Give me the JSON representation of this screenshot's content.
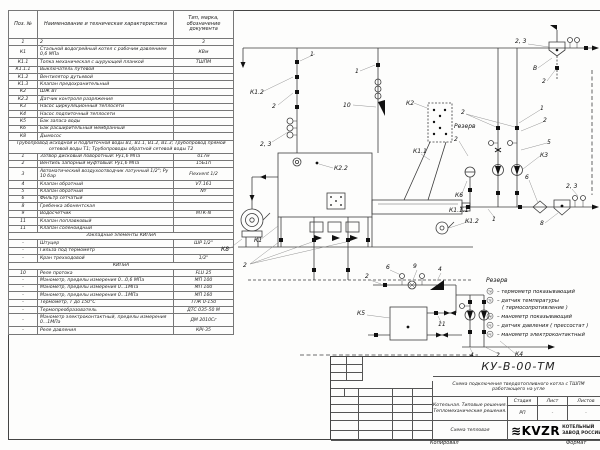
{
  "parts_table": {
    "headers": [
      "Поз. №",
      "Наименование и техническая характеристика",
      "Тип, марка, обозначение документа"
    ],
    "rows": [
      {
        "p": "1",
        "n": "2",
        "t": "3"
      },
      {
        "p": "К1",
        "n": "Стальной водогрейный котел с рабочим давлением 0,6 МПа",
        "t": "КВм"
      },
      {
        "p": "К1.1",
        "n": "Топка механическая с шурующей планкой",
        "t": "ТШПМ"
      },
      {
        "p": "К1.1.1",
        "n": "Выключатель путевой",
        "t": ""
      },
      {
        "p": "К1.2",
        "n": "Вентилятор дутьевой",
        "t": ""
      },
      {
        "p": "К1.3",
        "n": "Клапан предохранительный",
        "t": ""
      },
      {
        "p": "К2",
        "n": "ШЖ ВТ",
        "t": ""
      },
      {
        "p": "К2.2",
        "n": "Датчик контроля разряжения",
        "t": ""
      },
      {
        "p": "К3",
        "n": "Насос циркуляционный теплосети",
        "t": ""
      },
      {
        "p": "К4",
        "n": "Насос подпиточный теплосети",
        "t": ""
      },
      {
        "p": "К5",
        "n": "Бак запаса воды",
        "t": ""
      },
      {
        "p": "К6",
        "n": "Бак расширительный мембранный",
        "t": ""
      },
      {
        "p": "К8",
        "n": "Дымосос",
        "t": ""
      },
      {
        "s": "Трубопровод исходной и подпиточной воды В1, В1.1, В1.2, В1.3; Трубопровод прямой сетевой воды Т1; Трубопроводы обратной сетевой воды Т2"
      },
      {
        "p": "1",
        "n": "Затвор дисковый поворотный: Ру1,6 МПа",
        "t": "017м"
      },
      {
        "p": "2",
        "n": "Вентиль запорный муфтовый: Ру1,6 МПа",
        "t": "15Б1п"
      },
      {
        "p": "3",
        "n": "Автоматический воздухоотводчик латунный 1/2\"; Ру 10 бар",
        "t": "Flexvent 1/2"
      },
      {
        "p": "4",
        "n": "Клапан обратный",
        "t": "V7.161"
      },
      {
        "p": "5",
        "n": "Клапан обратный",
        "t": "NY"
      },
      {
        "p": "6",
        "n": "Фильтр сетчатый",
        "t": ""
      },
      {
        "p": "8",
        "n": "Гребенка абонентская",
        "t": ""
      },
      {
        "p": "9",
        "n": "Водосчетчик",
        "t": "МТК-N"
      },
      {
        "p": "11",
        "n": "Клапан поплавковый",
        "t": ""
      },
      {
        "p": "11",
        "n": "Клапан соленоидный",
        "t": ""
      },
      {
        "s": "Закладные элементы КИПиА"
      },
      {
        "p": "–",
        "n": "Штуцер",
        "t": "ШР 1/2\""
      },
      {
        "p": "–",
        "n": "Гильза под термометр",
        "t": ""
      },
      {
        "p": "–",
        "n": "Кран трехходовой",
        "t": "1/2\""
      },
      {
        "s": "КИПиА"
      },
      {
        "p": "10",
        "n": "Реле протока",
        "t": "FLU 25"
      },
      {
        "p": "–",
        "n": "Манометр, пределы измерения 0...0,6 МПа",
        "t": "МП 100"
      },
      {
        "p": "–",
        "n": "Манометр, пределы измерения 0...1МПа",
        "t": "МП 100"
      },
      {
        "p": "–",
        "n": "Манометр, пределы измерения 0...1МПа",
        "t": "МП 160"
      },
      {
        "p": "–",
        "n": "Термометр, Т до 150°С",
        "t": "ТТЖ 0-150"
      },
      {
        "p": "–",
        "n": "Термопреобразователь",
        "t": "ДТС 035-50 М"
      },
      {
        "p": "–",
        "n": "Манометр электроконтактный, пределы измерения 0...1МПа",
        "t": "ДМ 2010Сг"
      },
      {
        "p": "–",
        "n": "Реле давления",
        "t": "КРI-35"
      }
    ]
  },
  "schematic": {
    "labels": [
      {
        "t": "1",
        "x": 92,
        "y": 46
      },
      {
        "t": "К1.2",
        "x": 32,
        "y": 84
      },
      {
        "t": "2",
        "x": 54,
        "y": 98
      },
      {
        "t": "2, 3",
        "x": 42,
        "y": 136
      },
      {
        "t": "1",
        "x": 137,
        "y": 63
      },
      {
        "t": "10",
        "x": 125,
        "y": 97
      },
      {
        "t": "2, 3",
        "x": 297,
        "y": 33
      },
      {
        "t": "В",
        "x": 315,
        "y": 60
      },
      {
        "t": "2",
        "x": 324,
        "y": 73
      },
      {
        "t": "К2.2",
        "x": 116,
        "y": 160
      },
      {
        "t": "К1",
        "x": 36,
        "y": 232
      },
      {
        "t": "К8",
        "x": 3,
        "y": 241
      },
      {
        "t": "2",
        "x": 25,
        "y": 257
      },
      {
        "t": "К2",
        "x": 188,
        "y": 95
      },
      {
        "t": "Резерв",
        "x": 236,
        "y": 118
      },
      {
        "t": "К1.1",
        "x": 195,
        "y": 143
      },
      {
        "t": "К1.1.1",
        "x": 231,
        "y": 202
      },
      {
        "t": "К1.2",
        "x": 247,
        "y": 213
      },
      {
        "t": "1",
        "x": 274,
        "y": 211
      },
      {
        "t": "2",
        "x": 243,
        "y": 104
      },
      {
        "t": "1",
        "x": 322,
        "y": 100
      },
      {
        "t": "2",
        "x": 325,
        "y": 112
      },
      {
        "t": "5",
        "x": 329,
        "y": 134
      },
      {
        "t": "К3",
        "x": 322,
        "y": 147
      },
      {
        "t": "2",
        "x": 236,
        "y": 131
      },
      {
        "t": "К6",
        "x": 237,
        "y": 187
      },
      {
        "t": "6",
        "x": 307,
        "y": 169
      },
      {
        "t": "8",
        "x": 322,
        "y": 215
      },
      {
        "t": "2, 3",
        "x": 348,
        "y": 178
      },
      {
        "t": "2",
        "x": 147,
        "y": 268
      },
      {
        "t": "6",
        "x": 168,
        "y": 259
      },
      {
        "t": "9",
        "x": 195,
        "y": 258
      },
      {
        "t": "4",
        "x": 220,
        "y": 261
      },
      {
        "t": "К5",
        "x": 139,
        "y": 305
      },
      {
        "t": "11",
        "x": 220,
        "y": 316
      },
      {
        "t": "4",
        "x": 252,
        "y": 347
      },
      {
        "t": "2",
        "x": 278,
        "y": 347
      },
      {
        "t": "К4",
        "x": 297,
        "y": 346
      }
    ],
    "legend": {
      "title": "Резерв",
      "items": [
        {
          "sym": "ТИ",
          "text": "–  термометр показывающий",
          "text2": ""
        },
        {
          "sym": "ТЕ",
          "text": "–  датчик температуры",
          "text2": "( термосопротивление )"
        },
        {
          "sym": "РИ",
          "text": "–  манометр показывающий",
          "text2": ""
        },
        {
          "sym": "РЕ",
          "text": "–  датчик давления ( прессостат )",
          "text2": ""
        },
        {
          "sym": "РЕ",
          "text": "–  манометр электроконтактный",
          "text2": ""
        }
      ]
    }
  },
  "title_block": {
    "doc_number": "КУ-В-00-ТМ",
    "subtitle": "Схема подключения твердотопливного котла с ТШПМ работающего на угле",
    "project_line1": "Котельная. Типовые решения.",
    "project_line2": "Тепломеханические решения.",
    "sheet_name": "Схема тепловая",
    "stage_label": "Стадия",
    "sheet_label": "Лист",
    "sheets_label": "Листов",
    "stage": "РП",
    "sheet": "-",
    "sheets": "-",
    "sign_cols": [
      "Изм",
      "Лист",
      "N докум.",
      "Подп.",
      "Дата"
    ],
    "sign_rows": [
      "Проект.",
      "Проверил",
      "ГИП"
    ],
    "logo_mark": "≋",
    "logo_text": "KVZR",
    "logo_caption1": "КОТЕЛЬНЫЙ",
    "logo_caption2": "ЗАВОД РОССИИ"
  },
  "footer": {
    "copy": "Копировал",
    "format": "Формат"
  }
}
